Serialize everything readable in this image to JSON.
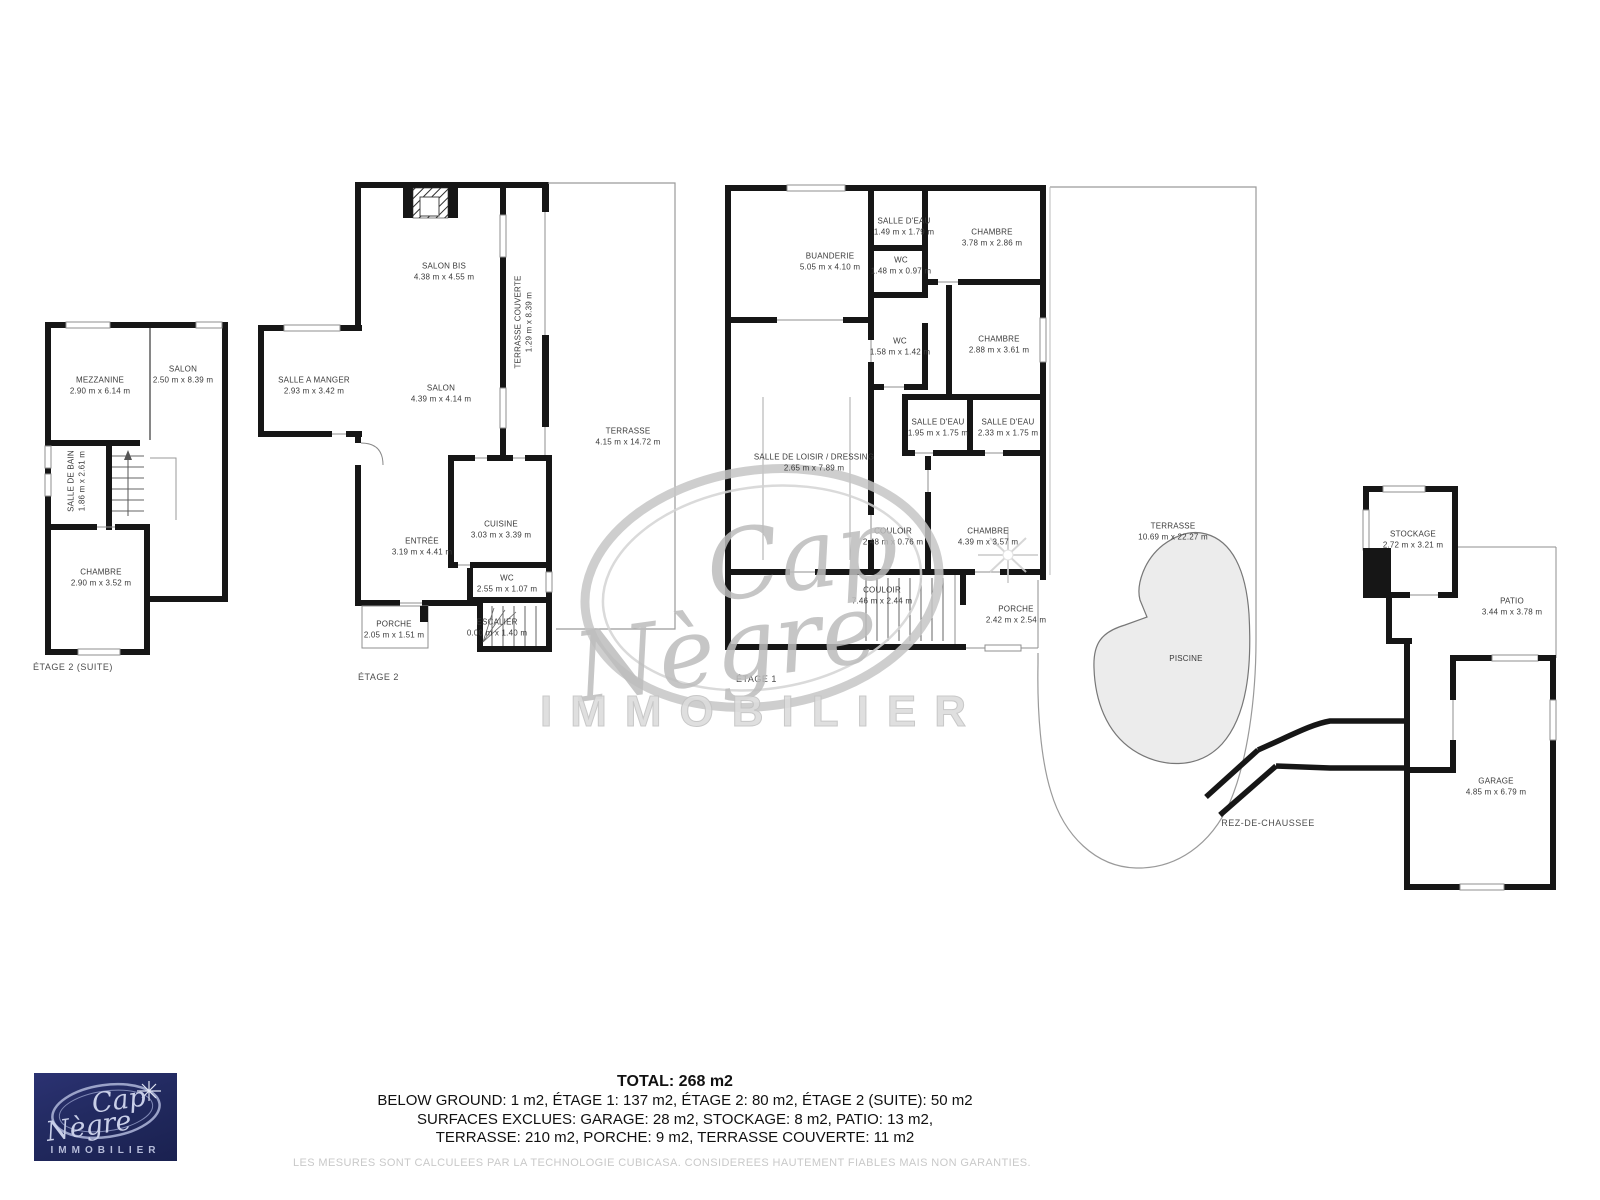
{
  "floors": [
    {
      "label": "ÉTAGE 2 (SUITE)",
      "rooms": [
        {
          "name": "MEZZANINE",
          "dims": "2.90 m x 6.14 m"
        },
        {
          "name": "SALON",
          "dims": "2.50 m x 8.39 m"
        },
        {
          "name": "SALLE DE BAIN",
          "dims": "1.86 m x 2.61 m"
        },
        {
          "name": "CHAMBRE",
          "dims": "2.90 m x 3.52 m"
        }
      ]
    },
    {
      "label": "ÉTAGE 2",
      "rooms": [
        {
          "name": "SALON BIS",
          "dims": "4.38 m x 4.55 m"
        },
        {
          "name": "SALLE A MANGER",
          "dims": "2.93 m x 3.42 m"
        },
        {
          "name": "SALON",
          "dims": "4.39 m x 4.14 m"
        },
        {
          "name": "TERRASSE COUVERTE",
          "dims": "1.29 m x 8.39 m"
        },
        {
          "name": "TERRASSE",
          "dims": "4.15 m x 14.72 m"
        },
        {
          "name": "CUISINE",
          "dims": "3.03 m x 3.39 m"
        },
        {
          "name": "ENTRÉE",
          "dims": "3.19 m x 4.41 m"
        },
        {
          "name": "WC",
          "dims": "2.55 m x 1.07 m"
        },
        {
          "name": "PORCHE",
          "dims": "2.05 m x 1.51 m"
        },
        {
          "name": "ESCALIER",
          "dims": "0.00 m x 1.40 m"
        }
      ]
    },
    {
      "label": "ÉTAGE 1",
      "rooms": [
        {
          "name": "BUANDERIE",
          "dims": "5.05 m x 4.10 m"
        },
        {
          "name": "SALLE D'EAU",
          "dims": "1.49 m x 1.79 m"
        },
        {
          "name": "WC",
          "dims": "1.48 m x 0.97 m"
        },
        {
          "name": "CHAMBRE",
          "dims": "3.78 m x 2.86 m"
        },
        {
          "name": "WC",
          "dims": "1.58 m x 1.42 m"
        },
        {
          "name": "CHAMBRE",
          "dims": "2.88 m x 3.61 m"
        },
        {
          "name": "SALLE DE LOISIR / DRESSING",
          "dims": "2.65 m x 7.89 m"
        },
        {
          "name": "SALLE D'EAU",
          "dims": "1.95 m x 1.75 m"
        },
        {
          "name": "SALLE D'EAU",
          "dims": "2.33 m x 1.75 m"
        },
        {
          "name": "COULOIR",
          "dims": "2.48 m x 0.76 m"
        },
        {
          "name": "CHAMBRE",
          "dims": "4.39 m x 3.57 m"
        },
        {
          "name": "COULOIR",
          "dims": "7.46 m x 2.44 m"
        },
        {
          "name": "PORCHE",
          "dims": "2.42 m x 2.54 m"
        }
      ]
    },
    {
      "label": "REZ-DE-CHAUSSEE",
      "rooms": [
        {
          "name": "TERRASSE",
          "dims": "10.69 m x 22.27 m"
        },
        {
          "name": "PISCINE",
          "dims": ""
        },
        {
          "name": "STOCKAGE",
          "dims": "2.72 m x 3.21 m"
        },
        {
          "name": "PATIO",
          "dims": "3.44 m x 3.78 m"
        },
        {
          "name": "GARAGE",
          "dims": "4.85 m x 6.79 m"
        }
      ]
    }
  ],
  "summary": {
    "total": "TOTAL: 268 m2",
    "line1": "BELOW GROUND: 1 m2, ÉTAGE 1: 137 m2, ÉTAGE 2: 80 m2, ÉTAGE 2 (SUITE): 50 m2",
    "line2": "SURFACES EXCLUES: GARAGE: 28 m2, STOCKAGE: 8 m2, PATIO: 13 m2,",
    "line3": "TERRASSE: 210 m2, PORCHE: 9 m2, TERRASSE COUVERTE: 11 m2"
  },
  "disclaimer": "LES MESURES SONT CALCULEES PAR LA TECHNOLOGIE CUBICASA. CONSIDEREES HAUTEMENT FIABLES MAIS NON GARANTIES.",
  "watermark": {
    "word1": "Cap",
    "word2": "Nègre",
    "word3": "IMMOBILIER"
  },
  "logo": {
    "word1": "Cap",
    "word2": "Nègre",
    "word3": "IMMOBILIER"
  },
  "colors": {
    "wall": "#161616",
    "thin": "#8f8f8f",
    "pool": "#ececec",
    "navy": "#232a5e"
  }
}
